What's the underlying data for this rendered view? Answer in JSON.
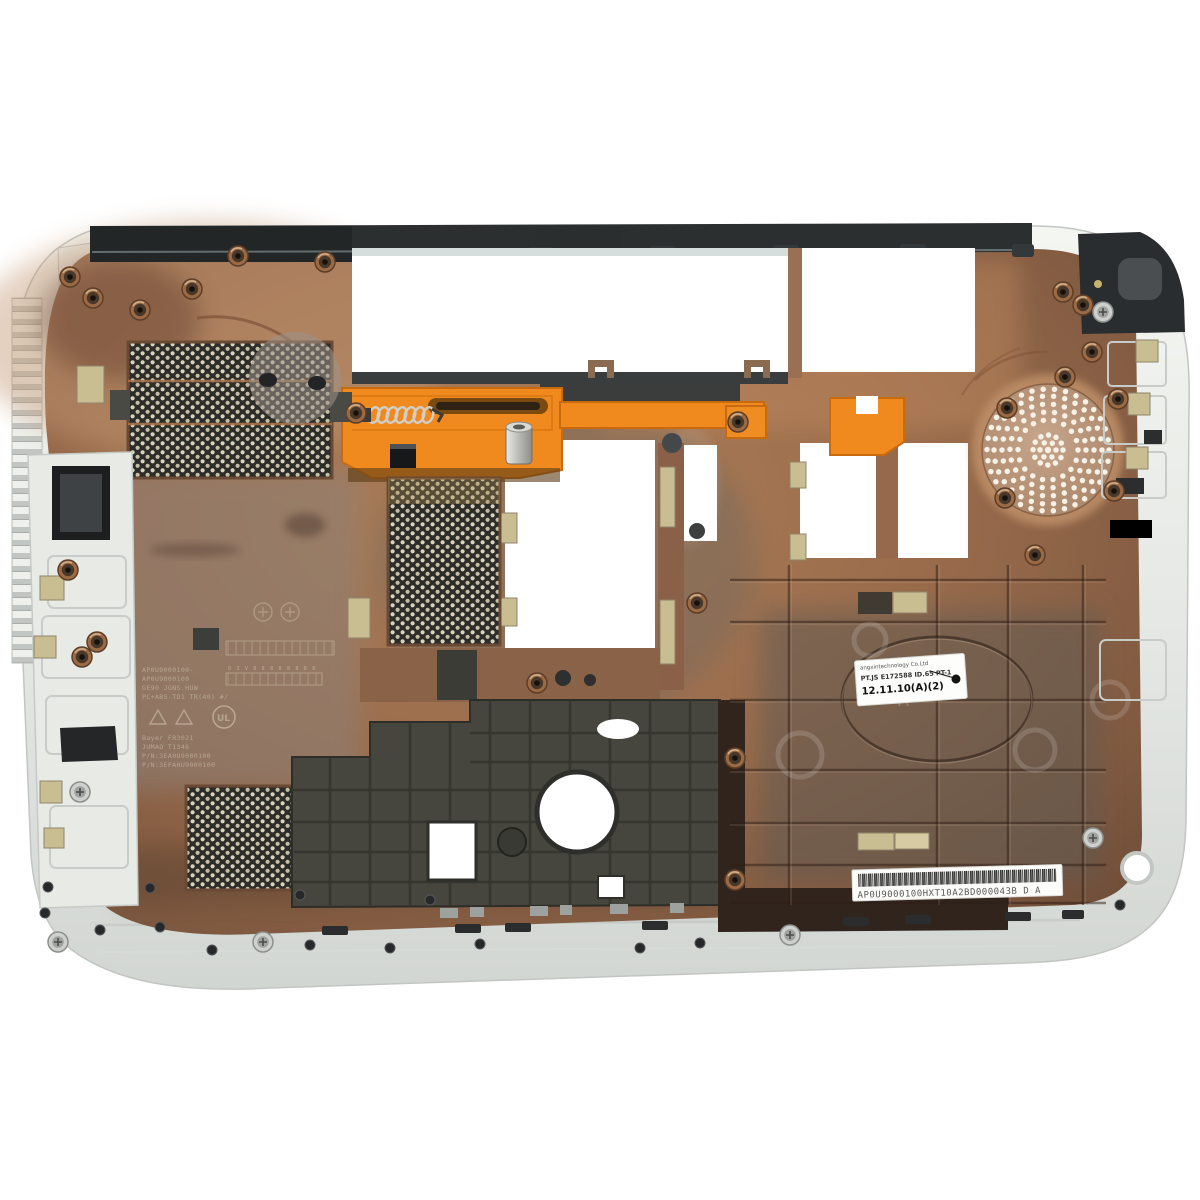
{
  "scene": {
    "type": "product-photo",
    "subject": "Laptop bottom case seen from the inside: white shell, copper EMI coated interior, orange battery latch, mesh vents, speaker grille",
    "background_color": "#ffffff"
  },
  "colors": {
    "shell_white": "#e9ebe7",
    "shell_shadow": "#c7cbc7",
    "copper": "#9a6c4c",
    "copper_light": "#c49a74",
    "copper_dark": "#6f4c38",
    "bay_gray": "#5e5a52",
    "dark_plastic": "#2c2f30",
    "latch_orange": "#f08a1e",
    "mesh_dark": "#2c2c28",
    "pad_khaki": "#c9bd92",
    "label_white": "#fdfdfb",
    "speaker_dot": "#f6f1e6"
  },
  "stickers": {
    "date_label": {
      "line1": "angxintechnology Co.Ltd",
      "line2": "PT.JS E172588 ID.65 PT-1",
      "line3": "12.11.10(A)(2)"
    },
    "barcode_label": {
      "text": "AP0U9000100HXT10A2BD000043B  D A"
    }
  },
  "molded_markings": {
    "lines": [
      "AP0U9000100-",
      "AP0U9000100",
      "GE90 JGNS.HUW",
      "PC+ABS-TD1 TR(40) #/",
      "Bayer FR3021",
      "JUMAO T1346",
      "P/N:3EA0U9000100",
      "P/N:3EFA0U9000100"
    ],
    "certification_mark": "UL",
    "mold_stamp": "A",
    "scale_digits": "0 3 V 8 8 8 8 8 8 8 8"
  }
}
